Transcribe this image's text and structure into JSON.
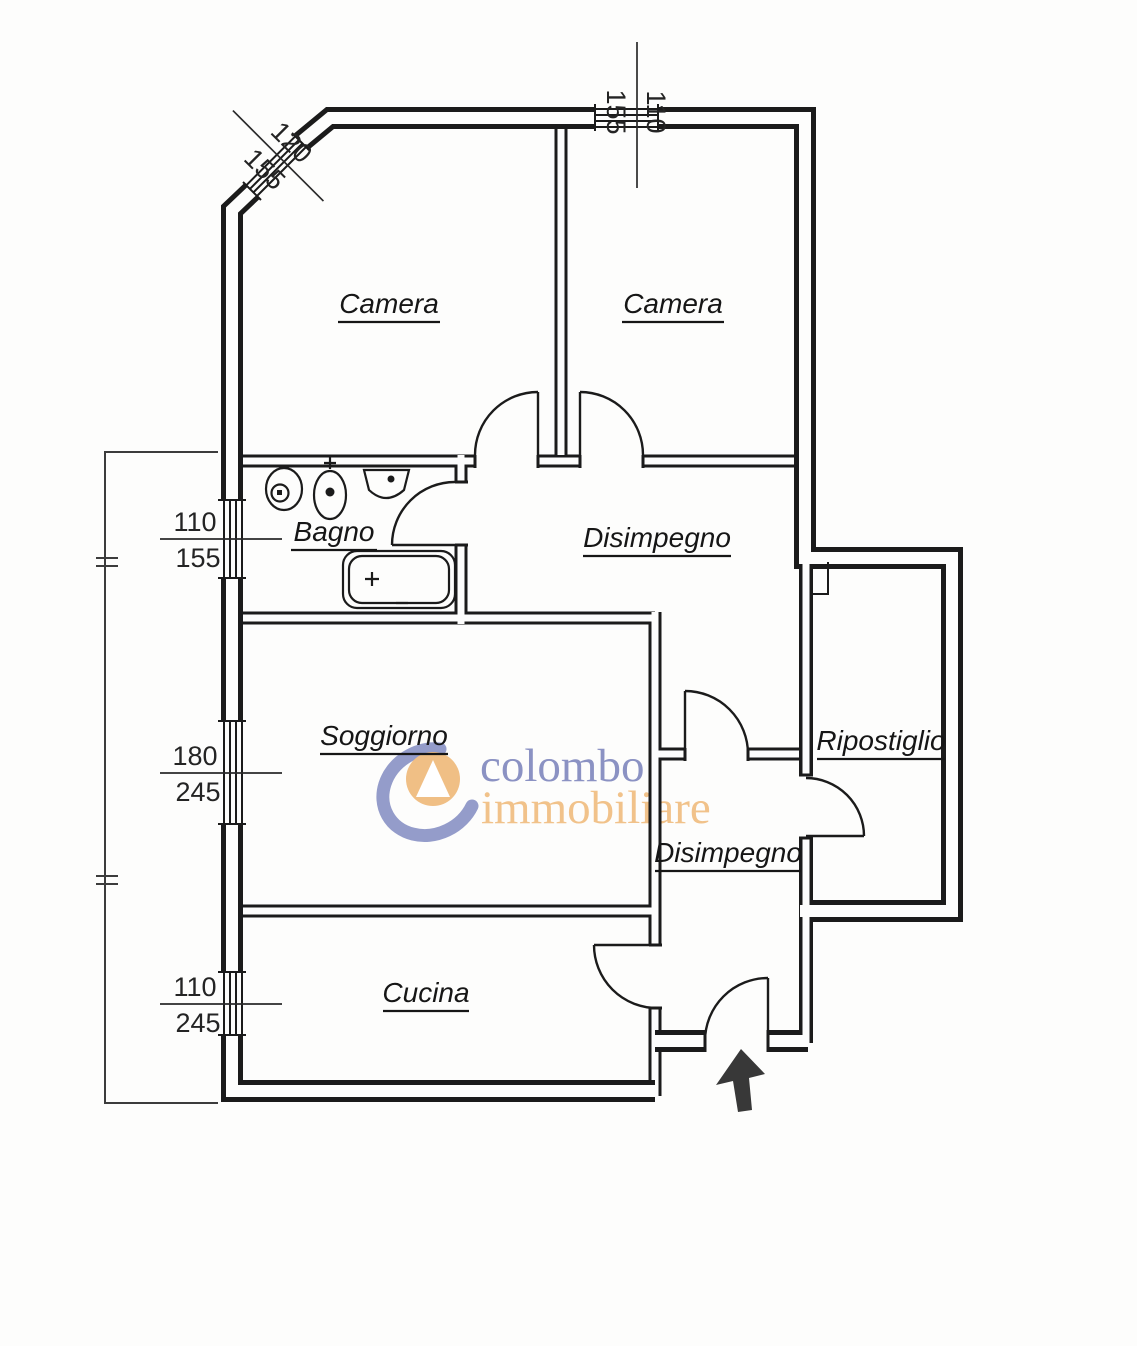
{
  "rooms": {
    "camera1": "Camera",
    "camera2": "Camera",
    "bagno": "Bagno",
    "disimpegno1": "Disimpegno",
    "soggiorno": "Soggiorno",
    "ripostiglio": "Ripostiglio",
    "disimpegno2": "Disimpegno",
    "cucina": "Cucina"
  },
  "dimensions": {
    "top_window": {
      "num": "110",
      "den": "155"
    },
    "corner_window": {
      "num": "120",
      "den": "155"
    },
    "bagno_window": {
      "num": "110",
      "den": "155"
    },
    "soggiorno_window": {
      "num": "180",
      "den": "245"
    },
    "cucina_window": {
      "num": "110",
      "den": "245"
    }
  },
  "watermark": {
    "line1": "colombo",
    "line2": "immobiliare",
    "line1_color": "#8b92c3",
    "line2_color": "#f1c28a",
    "swoosh_color": "#949cca",
    "circle_color": "#f0bf85"
  }
}
